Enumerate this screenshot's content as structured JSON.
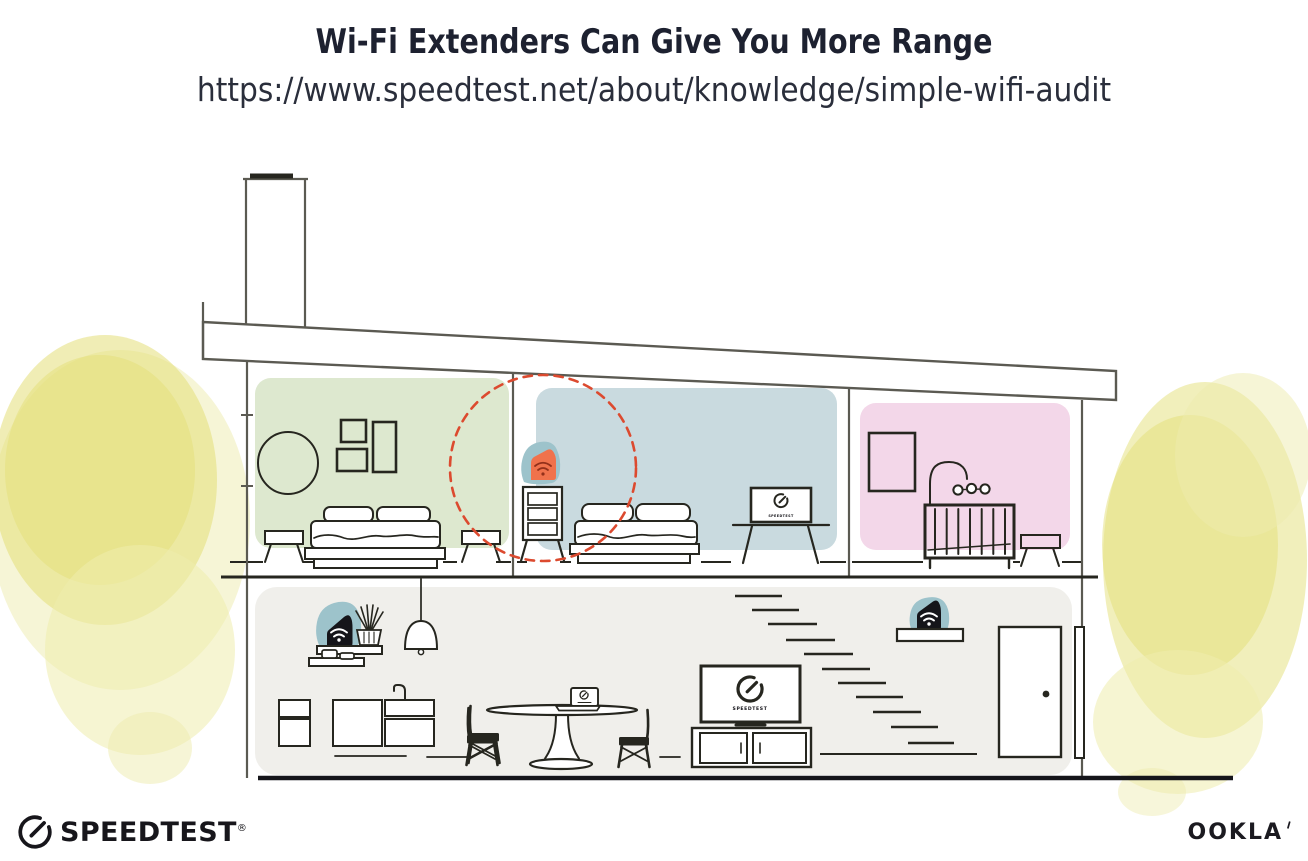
{
  "header": {
    "title": "Wi-Fi Extenders Can Give You More Range",
    "url": "https://www.speedtest.net/about/knowledge/simple-wifi-audit"
  },
  "illustration": {
    "screen_label": "SPEEDTEST",
    "colors": {
      "room_green": "#dde8cf",
      "room_blue": "#c9dadf",
      "room_pink": "#f3d7e9",
      "floor_gray": "#f0efeb",
      "device_teal": "#9dc3cb",
      "extender_orange": "#f0724c",
      "wifi_dark_red": "#93301a",
      "coverage_red": "#dc4a2f",
      "foliage_yellow": "#e3df78",
      "foliage_light": "#eeecad",
      "line_gray": "#5b5a52",
      "ink_dark": "#26261f",
      "device_black": "#15151a"
    }
  },
  "footer": {
    "speedtest_wordmark": "SPEEDTEST",
    "reg_mark": "®",
    "ookla_wordmark": "OOKLA"
  }
}
